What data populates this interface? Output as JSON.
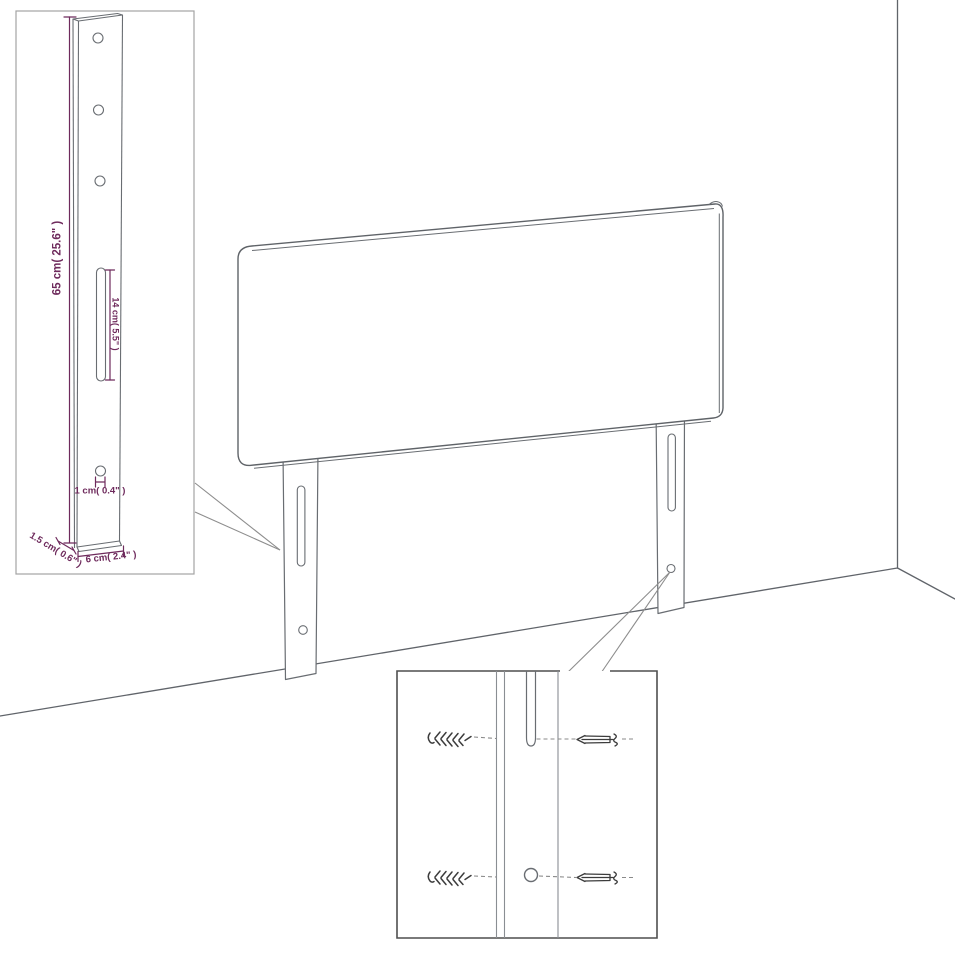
{
  "colors": {
    "background": "#ffffff",
    "line_art": "#5f6368",
    "dimension_accent": "#6e2a5c",
    "inset_border": "#a3a3a3",
    "detail_border": "#4f4f4f"
  },
  "leg_inset": {
    "height_label": "65 cm( 25.6\" )",
    "slot_label": "14 cm( 5.5\" )",
    "hole_label": "1 cm( 0.4\" )",
    "depth_label": "1.5 cm( 0.6\" )",
    "width_label": "6 cm( 2.4\" )"
  }
}
